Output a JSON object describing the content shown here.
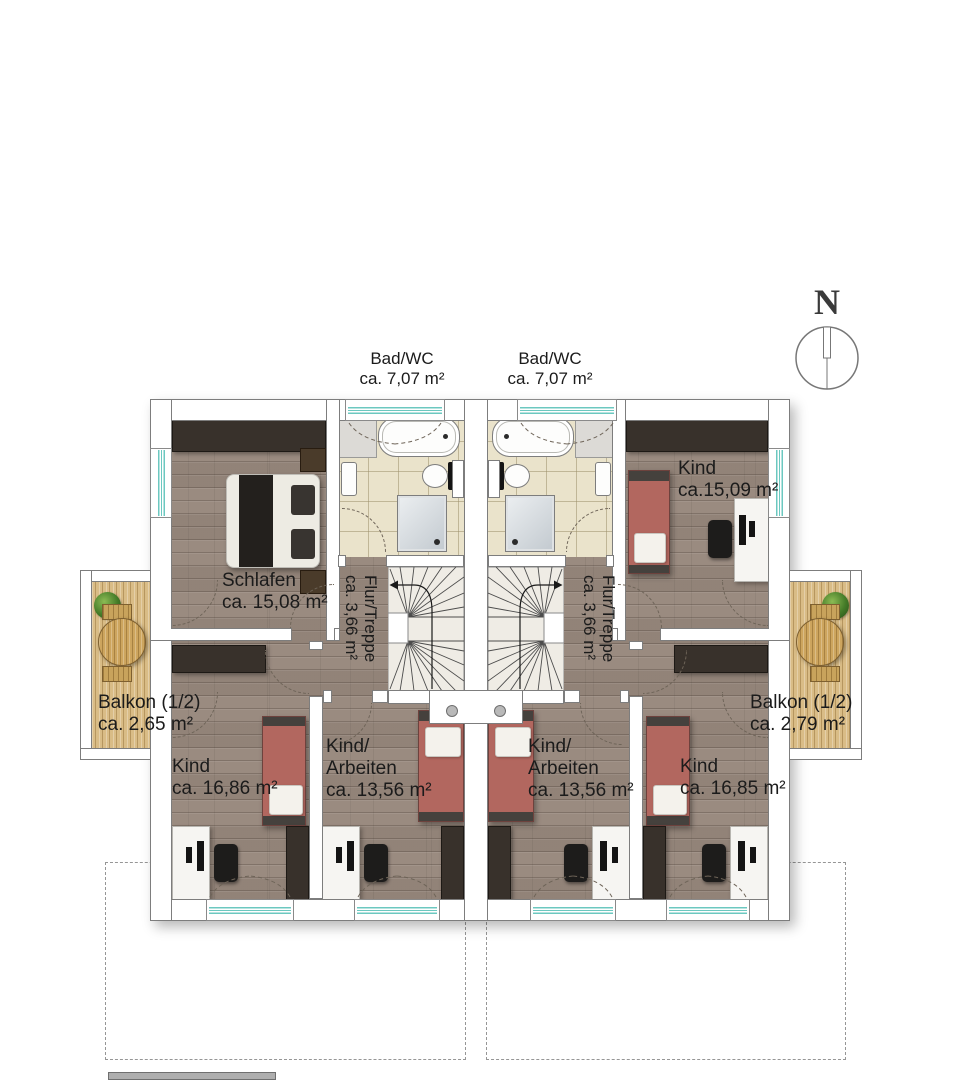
{
  "compass": {
    "north_label": "N"
  },
  "rooms": {
    "bad_wc_left": {
      "name": "Bad/WC",
      "area": "ca. 7,07 m²"
    },
    "bad_wc_right": {
      "name": "Bad/WC",
      "area": "ca. 7,07 m²"
    },
    "schlafen": {
      "name": "Schlafen",
      "area": "ca. 15,08 m²"
    },
    "kind_top_right": {
      "name": "Kind",
      "area": "ca.15,09 m²"
    },
    "flur_treppe_left": {
      "name": "Flur/Treppe",
      "area": "ca. 3,66 m²"
    },
    "flur_treppe_right": {
      "name": "Flur/Treppe",
      "area": "ca. 3,66 m²"
    },
    "balkon_left": {
      "name": "Balkon (1/2)",
      "area": "ca. 2,65 m²"
    },
    "balkon_right": {
      "name": "Balkon (1/2)",
      "area": "ca. 2,79 m²"
    },
    "kind_bottom_left": {
      "name": "Kind",
      "area": "ca. 16,86 m²"
    },
    "kind_arbeiten_left": {
      "name_line1": "Kind/",
      "name_line2": "Arbeiten",
      "area": "ca. 13,56 m²"
    },
    "kind_arbeiten_right": {
      "name_line1": "Kind/",
      "name_line2": "Arbeiten",
      "area": "ca. 13,56 m²"
    },
    "kind_bottom_right": {
      "name": "Kind",
      "area": "ca. 16,85 m²"
    }
  },
  "colors": {
    "wood_floor": "#9a8b80",
    "bath_tile": "#eae3cb",
    "balcony_deck": "#d9bc86",
    "wall_fill": "#ffffff",
    "wall_line": "#7d7d7d",
    "dark_furniture": "#38312b",
    "bed_red": "#b2675f",
    "stair_fill": "#efece5",
    "window_glass": "#6cc8c0",
    "label_text": "#1b1b1b"
  }
}
